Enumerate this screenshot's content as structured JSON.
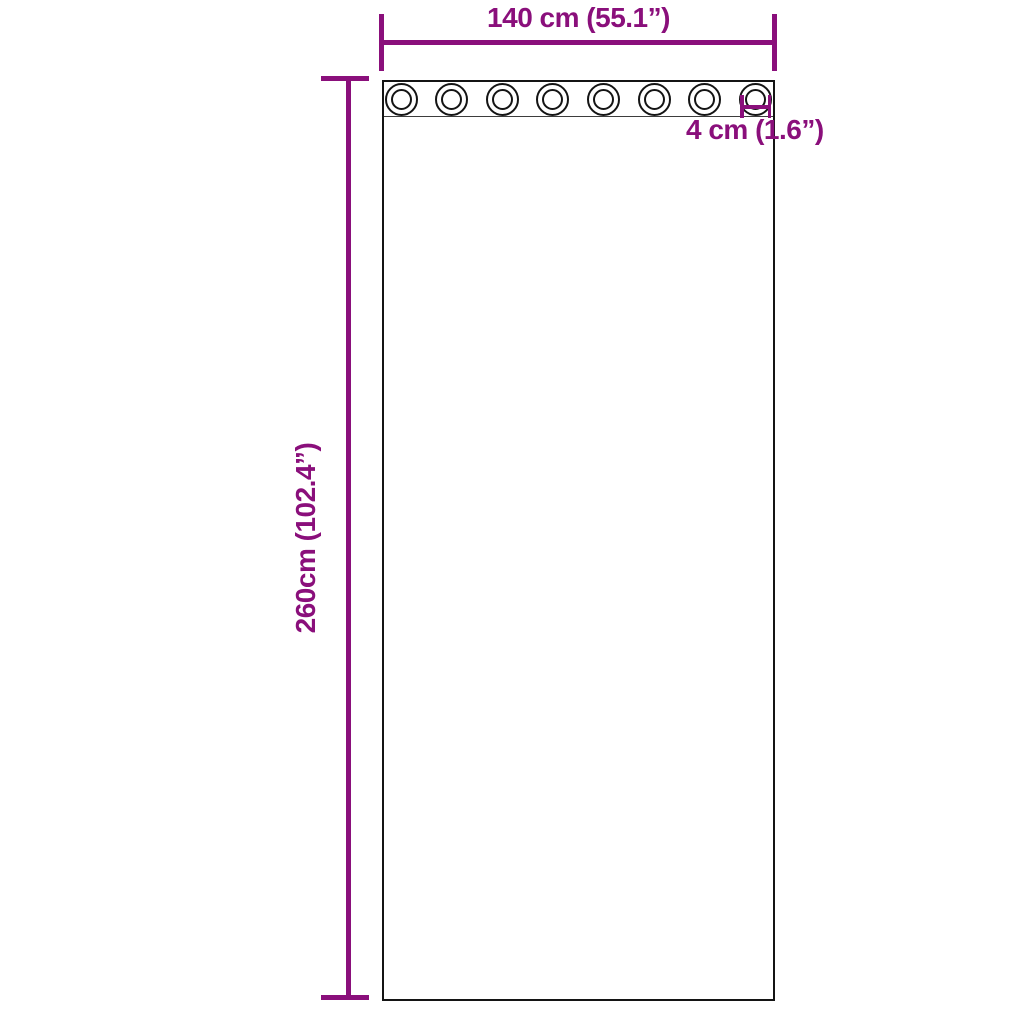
{
  "page": {
    "background": "#ffffff"
  },
  "colors": {
    "dimension": "#8a0f7b",
    "outline": "#141414",
    "band_line": "#3d3d3d"
  },
  "curtain": {
    "grommets": {
      "count": 8
    }
  },
  "dimensions": {
    "width": {
      "label": "140 cm (55.1”)"
    },
    "height": {
      "label": "260cm (102.4”)"
    },
    "grommet_diameter": {
      "label": "4 cm (1.6”)"
    }
  }
}
